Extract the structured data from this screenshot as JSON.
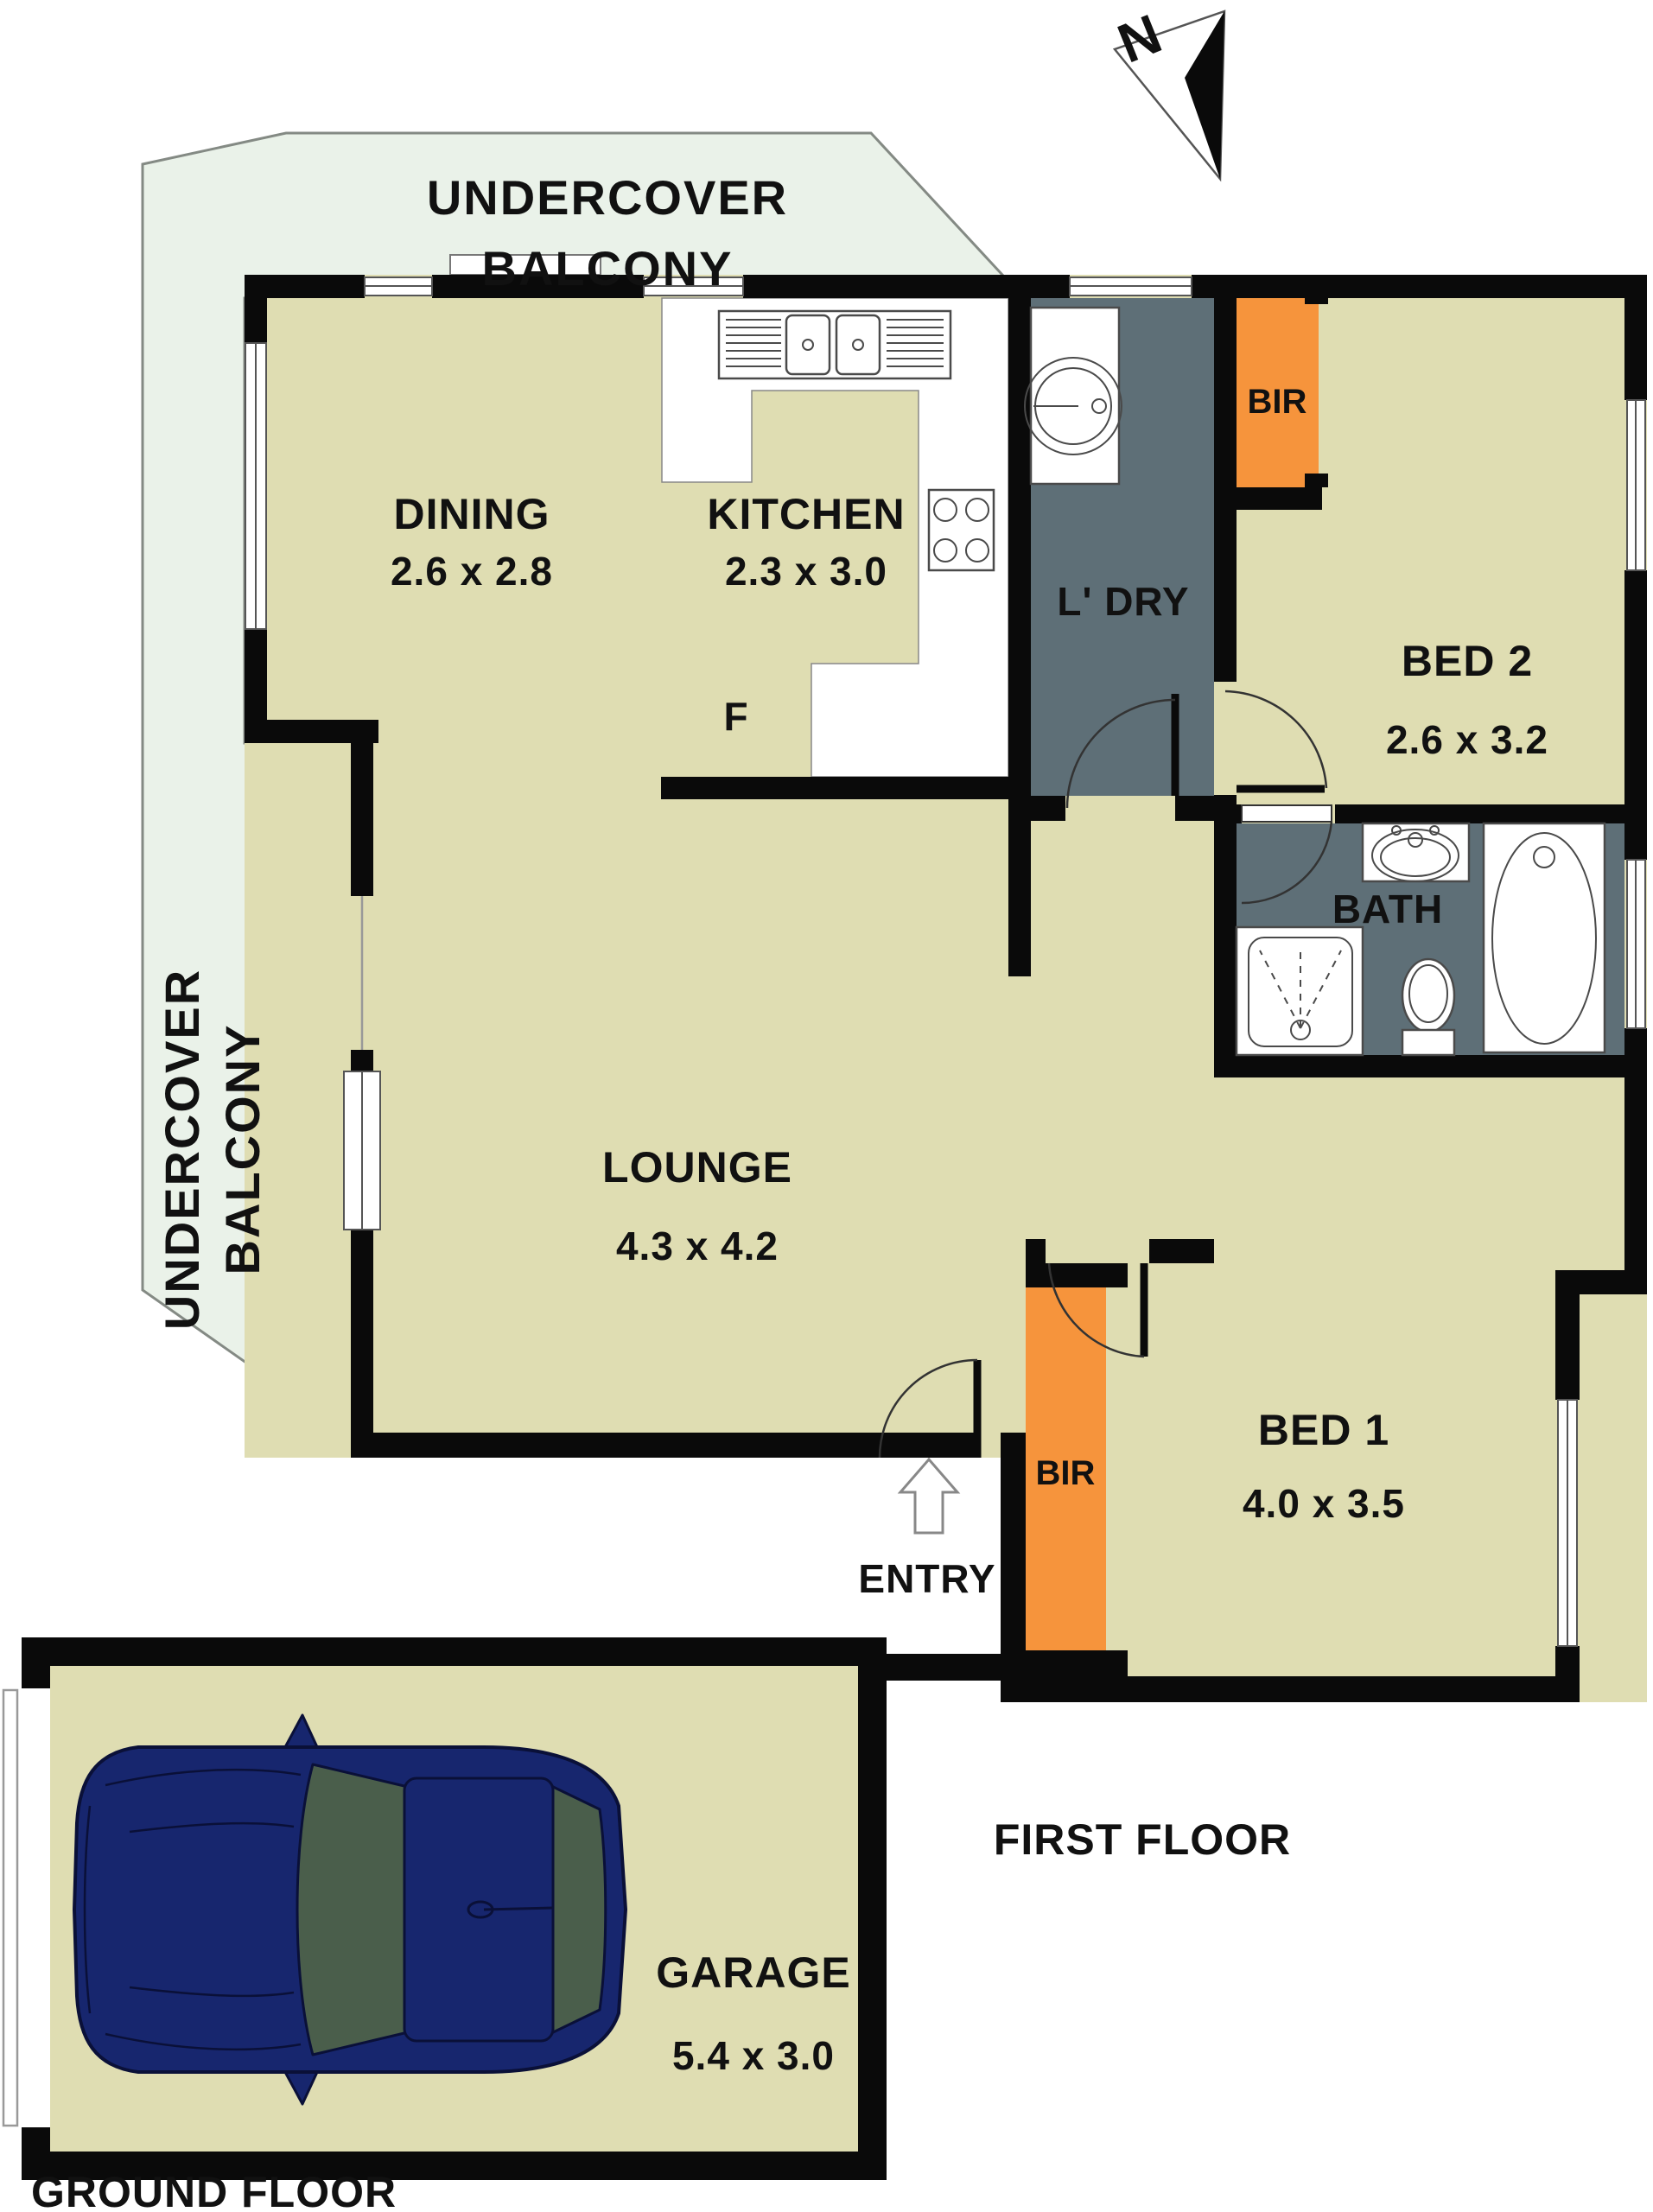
{
  "colors": {
    "wall": "#0a0a0a",
    "floor": "#dfddb2",
    "balcony": "#eaf2e9",
    "balcony_outline": "#848a84",
    "wet_area": "#5e6f77",
    "wardrobe": "#f6943c",
    "car_body": "#17266e",
    "car_window": "#4a5e4b",
    "car_outline": "#0a1038",
    "label": "#111111"
  },
  "north": {
    "label": "N"
  },
  "balcony_top": {
    "line1": "UNDERCOVER",
    "line2": "BALCONY"
  },
  "balcony_left": {
    "line1": "UNDERCOVER",
    "line2": "BALCONY"
  },
  "rooms": {
    "dining": {
      "name": "DINING",
      "dims": "2.6 x 2.8"
    },
    "kitchen": {
      "name": "KITCHEN",
      "dims": "2.3 x 3.0",
      "fridge": "F"
    },
    "laundry": {
      "name": "L' DRY"
    },
    "bed2": {
      "name": "BED 2",
      "dims": "2.6 x 3.2",
      "wardrobe": "BIR"
    },
    "bath": {
      "name": "BATH"
    },
    "lounge": {
      "name": "LOUNGE",
      "dims": "4.3 x 4.2"
    },
    "bed1": {
      "name": "BED 1",
      "dims": "4.0 x 3.5",
      "wardrobe": "BIR"
    },
    "entry": {
      "name": "ENTRY"
    },
    "garage": {
      "name": "GARAGE",
      "dims": "5.4 x 3.0"
    }
  },
  "floors": {
    "first": "FIRST FLOOR",
    "ground": "GROUND FLOOR"
  }
}
